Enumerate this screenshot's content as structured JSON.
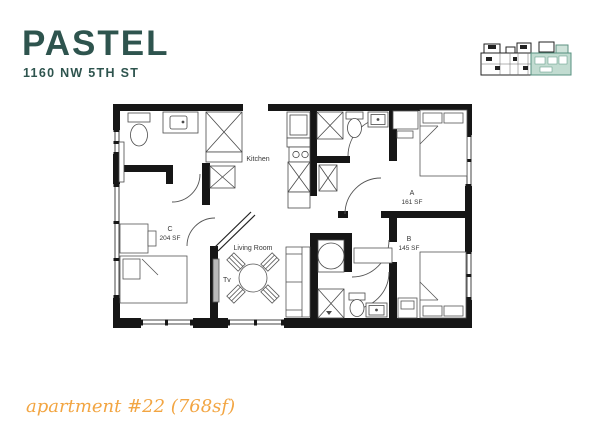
{
  "header": {
    "title": "PASTEL",
    "address": "1160 NW 5TH ST"
  },
  "footer": {
    "caption": "apartment #22 (768sf)"
  },
  "colors": {
    "brand_teal": "#2e544e",
    "accent_orange": "#f2a542",
    "wall_black": "#161616",
    "minimap_highlight": "#c2dcd1",
    "minimap_highlight_border": "#579180"
  },
  "floorplan": {
    "labels": {
      "kitchen": "Kitchen",
      "living_room": "Living Room",
      "tv": "Tv",
      "bedroom_a": "A",
      "bedroom_a_area": "161 SF",
      "bedroom_b": "B",
      "bedroom_b_area": "145 SF",
      "bedroom_c": "C",
      "bedroom_c_area": "204 SF"
    }
  }
}
